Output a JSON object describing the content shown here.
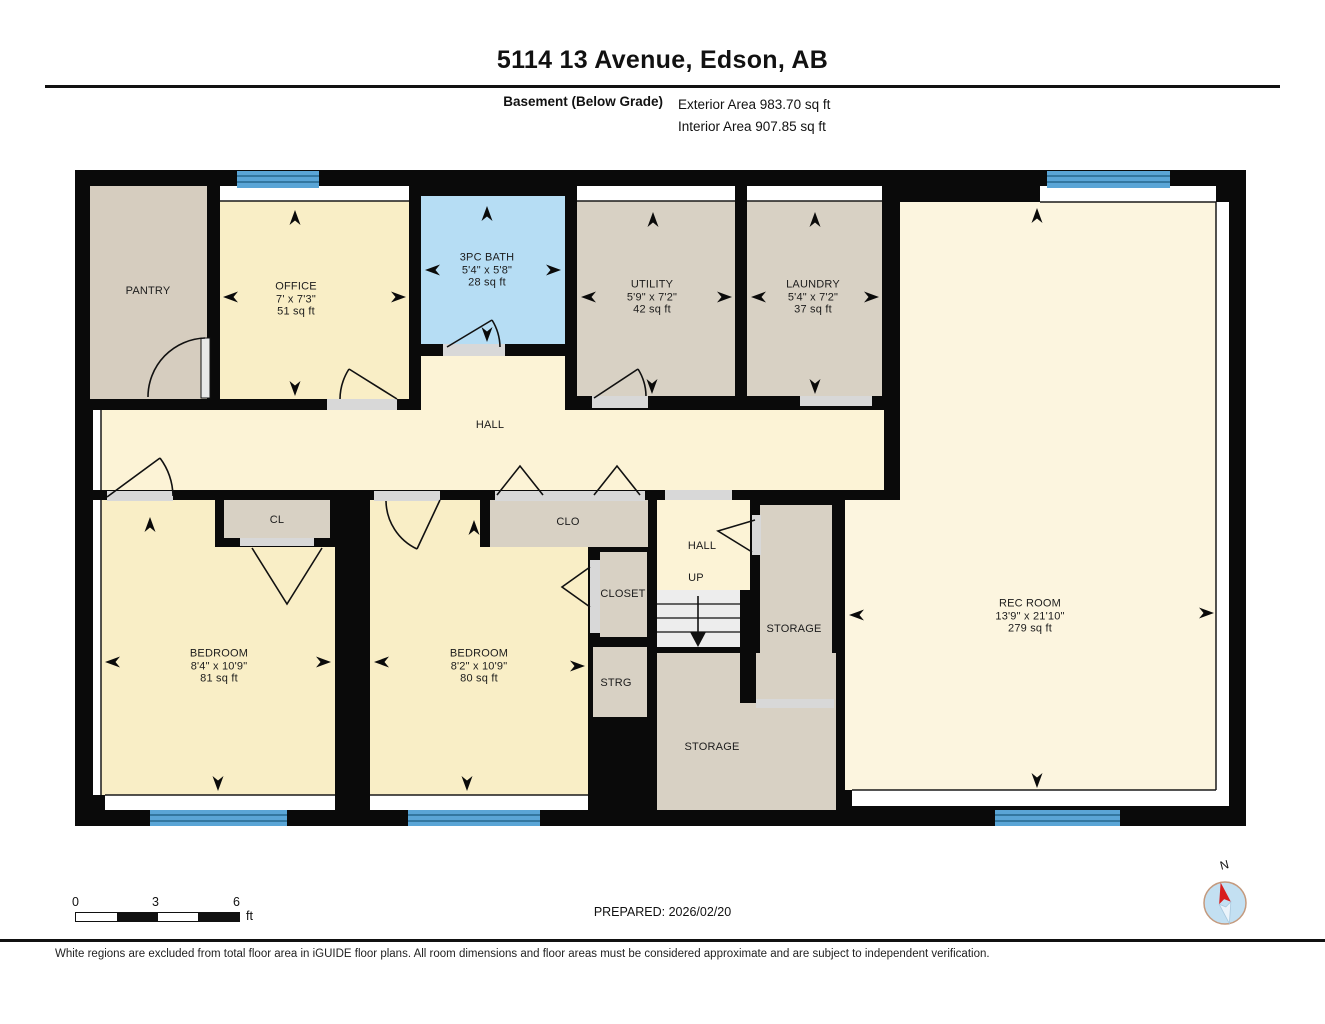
{
  "header": {
    "title": "5114 13 Avenue, Edson, AB",
    "floor_label": "Basement (Below Grade)",
    "exterior_area": "Exterior Area 983.70 sq ft",
    "interior_area": "Interior Area 907.85 sq ft"
  },
  "rooms": {
    "pantry": {
      "name": "PANTRY"
    },
    "office": {
      "name": "OFFICE",
      "dims": "7' x 7'3\"",
      "area": "51 sq ft"
    },
    "bath": {
      "name": "3PC BATH",
      "dims": "5'4\" x 5'8\"",
      "area": "28 sq ft"
    },
    "utility": {
      "name": "UTILITY",
      "dims": "5'9\" x 7'2\"",
      "area": "42 sq ft"
    },
    "laundry": {
      "name": "LAUNDRY",
      "dims": "5'4\" x 7'2\"",
      "area": "37 sq ft"
    },
    "rec_room": {
      "name": "REC ROOM",
      "dims": "13'9\" x 21'10\"",
      "area": "279 sq ft"
    },
    "hall": {
      "name": "HALL"
    },
    "bedroom1": {
      "name": "BEDROOM",
      "dims": "8'4\" x 10'9\"",
      "area": "81 sq ft"
    },
    "bedroom2": {
      "name": "BEDROOM",
      "dims": "8'2\" x 10'9\"",
      "area": "80 sq ft"
    },
    "cl": {
      "name": "CL"
    },
    "clo": {
      "name": "CLO"
    },
    "closet": {
      "name": "CLOSET"
    },
    "hall2": {
      "name": "HALL"
    },
    "up": {
      "name": "UP"
    },
    "strg": {
      "name": "STRG"
    },
    "storage_upper": {
      "name": "STORAGE"
    },
    "storage_lower": {
      "name": "STORAGE"
    }
  },
  "footer": {
    "prepared": "PREPARED: 2026/02/20",
    "scale_ticks": [
      "0",
      "3",
      "6"
    ],
    "scale_unit": "ft",
    "compass_label": "N",
    "disclaimer": "White regions are excluded from total floor area in iGUIDE floor plans. All room dimensions and floor areas must be considered approximate and are subject to independent verification."
  },
  "colors": {
    "wall": "#0A0A0A",
    "room_cream": "#F9EEC6",
    "hall_cream": "#FCF3D6",
    "rec_cream": "#FCF5DF",
    "tan": "#D8D1C4",
    "pantry_tan": "#D6CDBF",
    "bath_blue": "#B6DDF4",
    "window_blue": "#5AA5D6",
    "window_line": "#26688E",
    "sill_gray": "#D8D8D8",
    "stairs_gray": "#EDEDED"
  }
}
